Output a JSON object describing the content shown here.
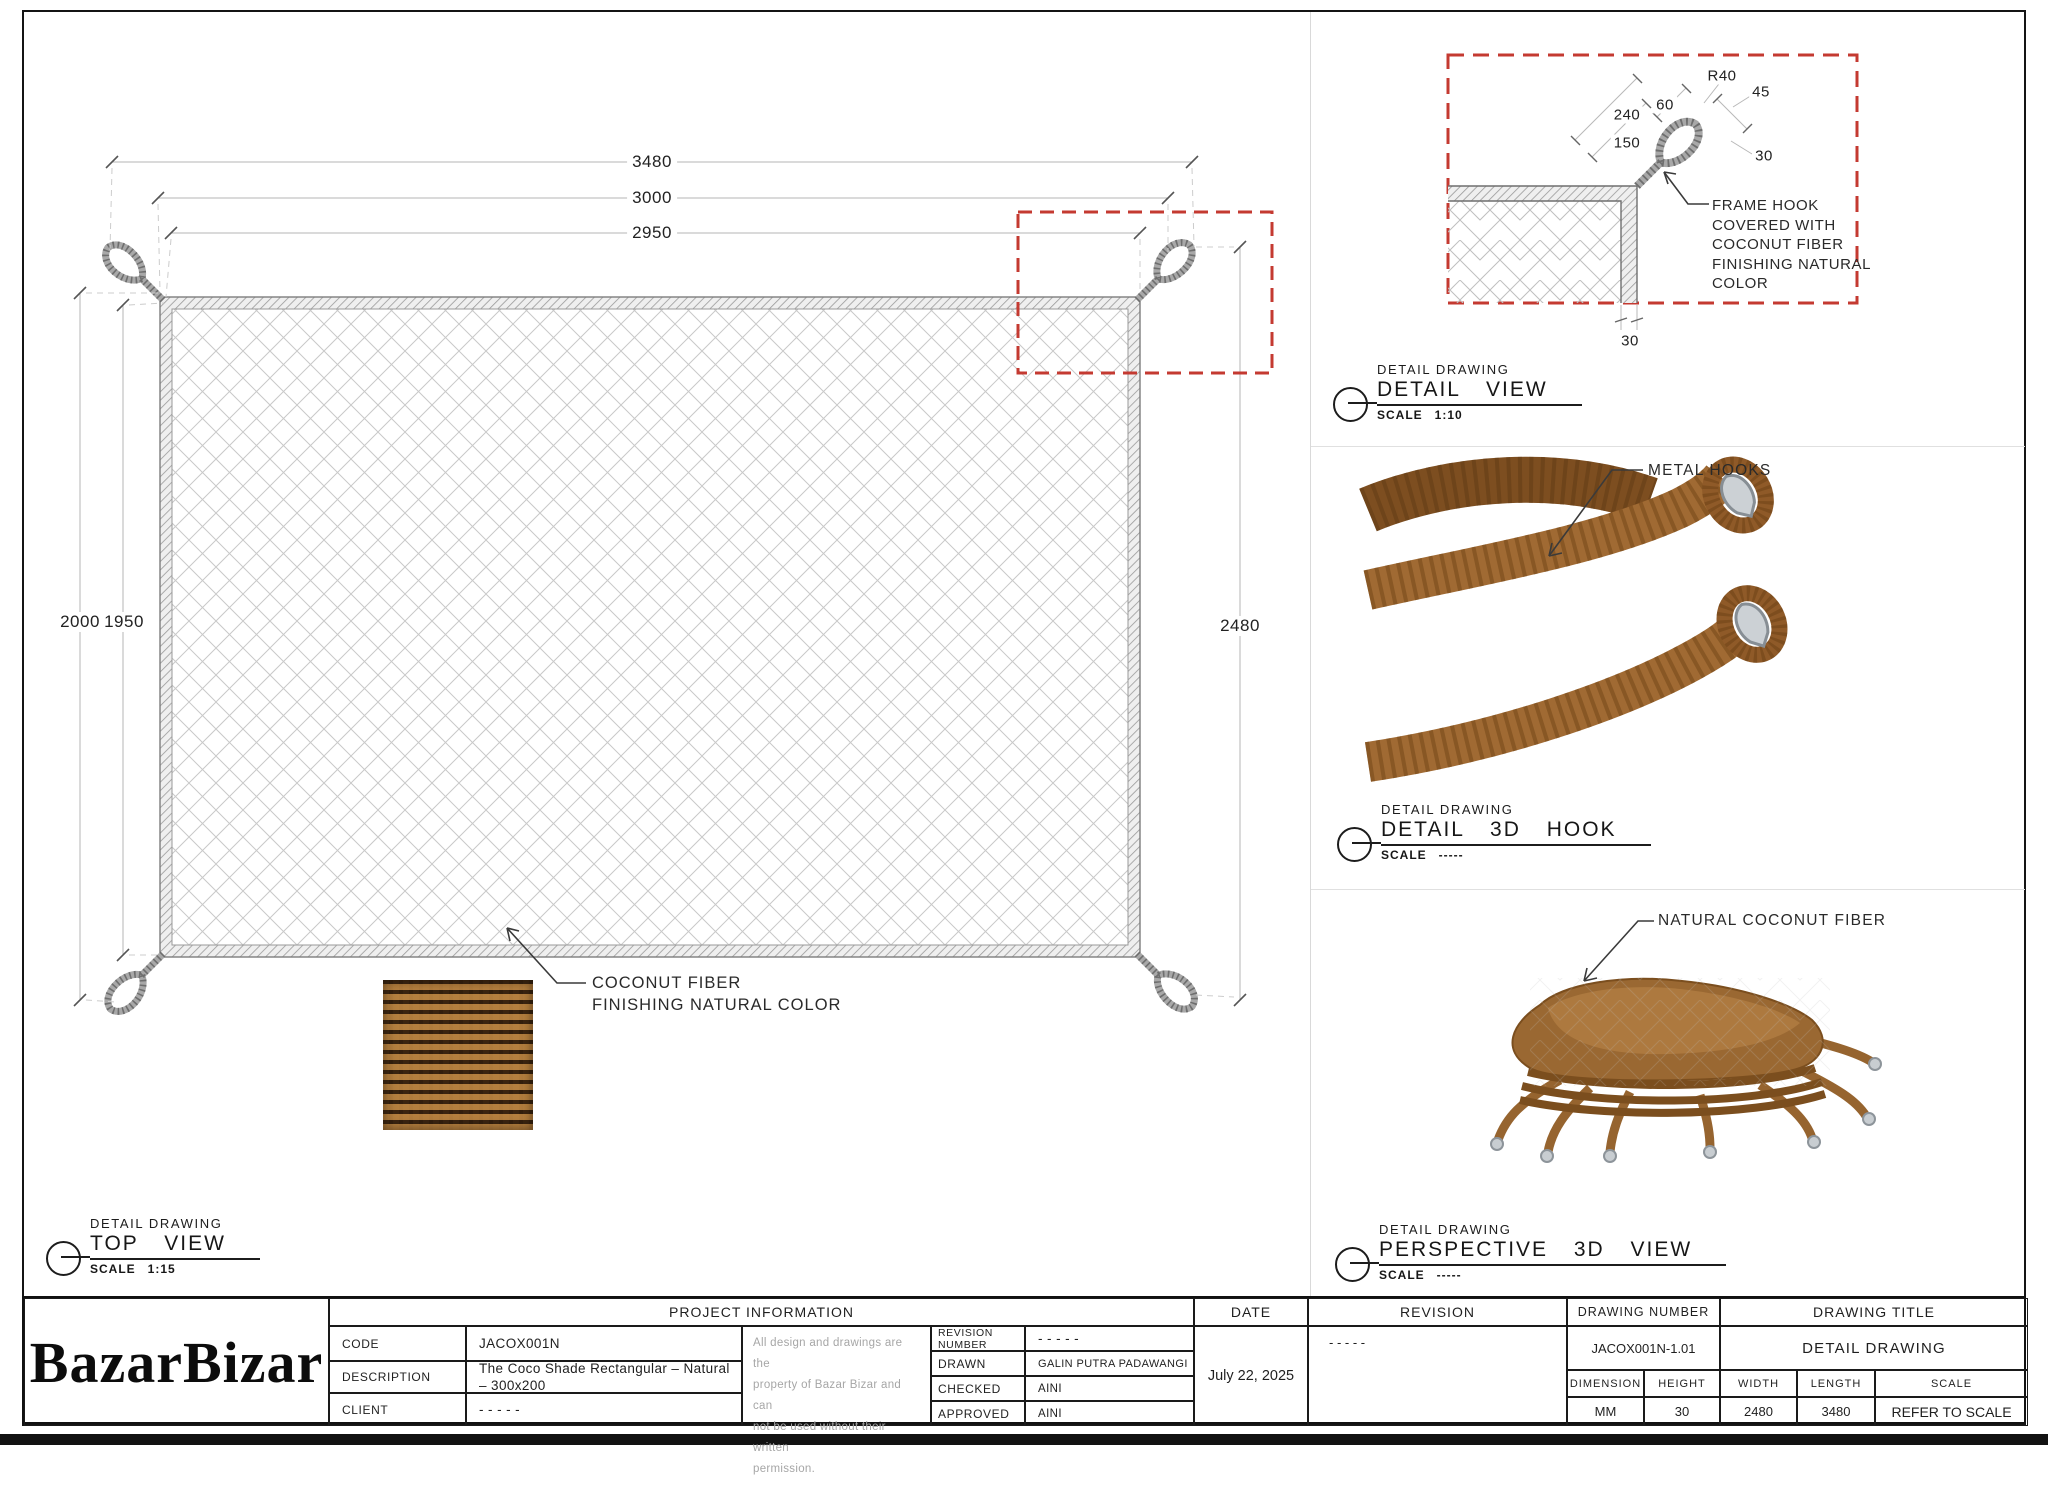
{
  "top_view": {
    "section_label": "DETAIL DRAWING",
    "view_name": "TOP VIEW",
    "scale_label": "SCALE",
    "scale_value": "1:15",
    "dims": {
      "overall_width": "3480",
      "hook_width": "3000",
      "net_width": "2950",
      "overall_height": "2000",
      "net_height": "1950",
      "side_height": "2480"
    },
    "fiber_note": [
      "COCONUT FIBER",
      "FINISHING NATURAL COLOR"
    ]
  },
  "detail_view": {
    "section_label": "DETAIL DRAWING",
    "view_name": "DETAIL VIEW",
    "scale_label": "SCALE",
    "scale_value": "1:10",
    "dims": {
      "radius": "R40",
      "d45": "45",
      "d240": "240",
      "d60": "60",
      "d150": "150",
      "d30_side": "30",
      "d30_bottom": "30"
    },
    "note": [
      "FRAME HOOK",
      "COVERED WITH",
      "COCONUT FIBER",
      "FINISHING NATURAL",
      "COLOR"
    ]
  },
  "hook_view": {
    "section_label": "DETAIL DRAWING",
    "view_name": "DETAIL 3D HOOK",
    "scale_label": "SCALE",
    "scale_value": "-----",
    "note": "METAL HOOKS"
  },
  "perspective_view": {
    "section_label": "DETAIL DRAWING",
    "view_name": "PERSPECTIVE 3D VIEW",
    "scale_label": "SCALE",
    "scale_value": "-----",
    "note": "NATURAL COCONUT FIBER"
  },
  "title_block": {
    "logo_part1": "Bazar",
    "logo_part2": "Bizar",
    "project_information": "PROJECT INFORMATION",
    "code_label": "CODE",
    "code_value": "JACOX001N",
    "description_label": "DESCRIPTION",
    "description_value": "The Coco Shade Rectangular – Natural – 300x200",
    "client_label": "CLIENT",
    "client_value": "- - - - -",
    "disclaimer": [
      "All design and drawings are the",
      "property of Bazar Bizar and can",
      "not be used without their written",
      "permission."
    ],
    "revision_number_label": "REVISION NUMBER",
    "revision_number_value": "- - - - -",
    "drawn_label": "DRAWN",
    "drawn_value": "GALIN PUTRA PADAWANGI",
    "checked_label": "CHECKED",
    "checked_value": "AINI",
    "approved_label": "APPROVED",
    "approved_value": "AINI",
    "date_label": "DATE",
    "date_value": "July 22, 2025",
    "revision_label": "REVISION",
    "revision_value": "- - - - -",
    "drawing_number_label": "DRAWING NUMBER",
    "drawing_number_value": "JACOX001N-1.01",
    "drawing_title_label": "DRAWING TITLE",
    "drawing_title_value": "DETAIL DRAWING",
    "dimension_label": "DIMENSION",
    "dimension_value": "MM",
    "height_label": "HEIGHT",
    "height_value": "30",
    "width_label": "WIDTH",
    "width_value": "2480",
    "length_label": "LENGTH",
    "length_value": "3480",
    "scale_label": "SCALE",
    "scale_value": "REFER TO SCALE"
  },
  "colors": {
    "accent_red": "#c43a31",
    "rope_brown": "#a06a33",
    "metal_gray": "#ccd1d5",
    "hatch_gray": "#9a9a9a"
  }
}
